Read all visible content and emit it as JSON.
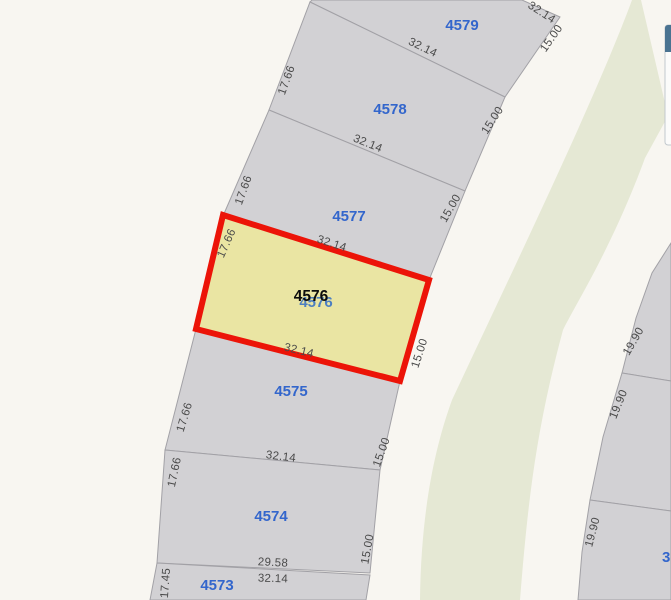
{
  "colors": {
    "background": "#f8f6f1",
    "parcel_fill": "#d2d1d4",
    "parcel_stroke": "#a2a1a6",
    "green_band": "#e5e8d4",
    "selected_fill": "#eae5a3",
    "selected_stroke": "#ec1408",
    "lot_label": "#3366cc",
    "lot_label_hidden": "#4d7fc0",
    "selected_label": "#0c0c0c",
    "dimension_text": "#4a4a4a"
  },
  "map": {
    "width": 671,
    "height": 600,
    "green_band_path": "M632,0 C597,95 520,255 452,400 C432,455 421,520 420,600 L520,600 C528,500 536,430 563,330 C575,305 612,248 645,158 L668,116 L641,0 Z",
    "parcels": [
      {
        "id": "4579",
        "points": "312,0 522,0 560,17 505,97 310,2",
        "label": {
          "text": "4579",
          "x": 462,
          "y": 30
        }
      },
      {
        "id": "4578",
        "points": "310,2 505,97 465,191 269,110",
        "label": {
          "text": "4578",
          "x": 390,
          "y": 114
        }
      },
      {
        "id": "4577",
        "points": "269,110 465,191 429,280 223,216",
        "label": {
          "text": "4577",
          "x": 349,
          "y": 221
        }
      },
      {
        "id": "4575",
        "points": "196,329 400,381 380,470 165,450",
        "label": {
          "text": "4575",
          "x": 291,
          "y": 396
        }
      },
      {
        "id": "4574",
        "points": "165,450 380,470 370,573 157,563",
        "label": {
          "text": "4574",
          "x": 271,
          "y": 521
        }
      },
      {
        "id": "4573",
        "points": "157,563 370,575 366,600 150,600",
        "label": {
          "text": "4573",
          "x": 217,
          "y": 590
        }
      }
    ],
    "right_parcels": [
      {
        "id": "right-lot-1",
        "points": "671,243 652,273 636,318 622,373 671,381"
      },
      {
        "id": "right-lot-2",
        "points": "622,373 671,381 671,511 590,500 603,437"
      },
      {
        "id": "right-lot-3",
        "points": "590,500 671,511 671,600 578,600 582,552"
      }
    ],
    "selected_parcel": {
      "id": "4576",
      "points": "223,215 429,280 400,381 196,329",
      "label": {
        "text": "4576",
        "x": 311,
        "y": 301
      },
      "shadow_label": {
        "text": "4576",
        "x": 316,
        "y": 307
      }
    },
    "partial_lot_label": {
      "text": "3",
      "x": 662,
      "y": 562
    },
    "dimensions": [
      {
        "text": "32.14",
        "x": 542,
        "y": 12,
        "rot": 33
      },
      {
        "text": "15.00",
        "x": 551,
        "y": 38,
        "rot": -55
      },
      {
        "text": "32.14",
        "x": 423,
        "y": 47,
        "rot": 26
      },
      {
        "text": "17.66",
        "x": 286,
        "y": 80,
        "rot": -70
      },
      {
        "text": "32.14",
        "x": 368,
        "y": 143,
        "rot": 22
      },
      {
        "text": "15.00",
        "x": 492,
        "y": 120,
        "rot": -57
      },
      {
        "text": "17.66",
        "x": 243,
        "y": 190,
        "rot": -70
      },
      {
        "text": "32.14",
        "x": 332,
        "y": 243,
        "rot": 18
      },
      {
        "text": "15.00",
        "x": 450,
        "y": 208,
        "rot": -60
      },
      {
        "text": "17.66",
        "x": 226,
        "y": 243,
        "rot": -66
      },
      {
        "text": "32.14",
        "x": 299,
        "y": 350,
        "rot": 14
      },
      {
        "text": "15.00",
        "x": 419,
        "y": 353,
        "rot": -72
      },
      {
        "text": "17.66",
        "x": 184,
        "y": 417,
        "rot": -73
      },
      {
        "text": "32.14",
        "x": 281,
        "y": 456,
        "rot": 7
      },
      {
        "text": "15.00",
        "x": 381,
        "y": 452,
        "rot": -70
      },
      {
        "text": "17.66",
        "x": 174,
        "y": 472,
        "rot": -78
      },
      {
        "text": "29.58",
        "x": 273,
        "y": 562,
        "rot": 3
      },
      {
        "text": "32.14",
        "x": 273,
        "y": 578,
        "rot": 2
      },
      {
        "text": "15.00",
        "x": 367,
        "y": 549,
        "rot": -80
      },
      {
        "text": "17.45",
        "x": 165,
        "y": 583,
        "rot": -86
      },
      {
        "text": "19.90",
        "x": 633,
        "y": 341,
        "rot": -60
      },
      {
        "text": "19.90",
        "x": 618,
        "y": 404,
        "rot": -68
      },
      {
        "text": "19.90",
        "x": 592,
        "y": 532,
        "rot": -75
      }
    ],
    "panel": {
      "x": 665,
      "y": 25,
      "width": 22,
      "height": 120,
      "header_height": 27,
      "header_color": "#4a7391",
      "body_color": "#fbfbfa",
      "border_color": "#c2c8cd"
    }
  }
}
